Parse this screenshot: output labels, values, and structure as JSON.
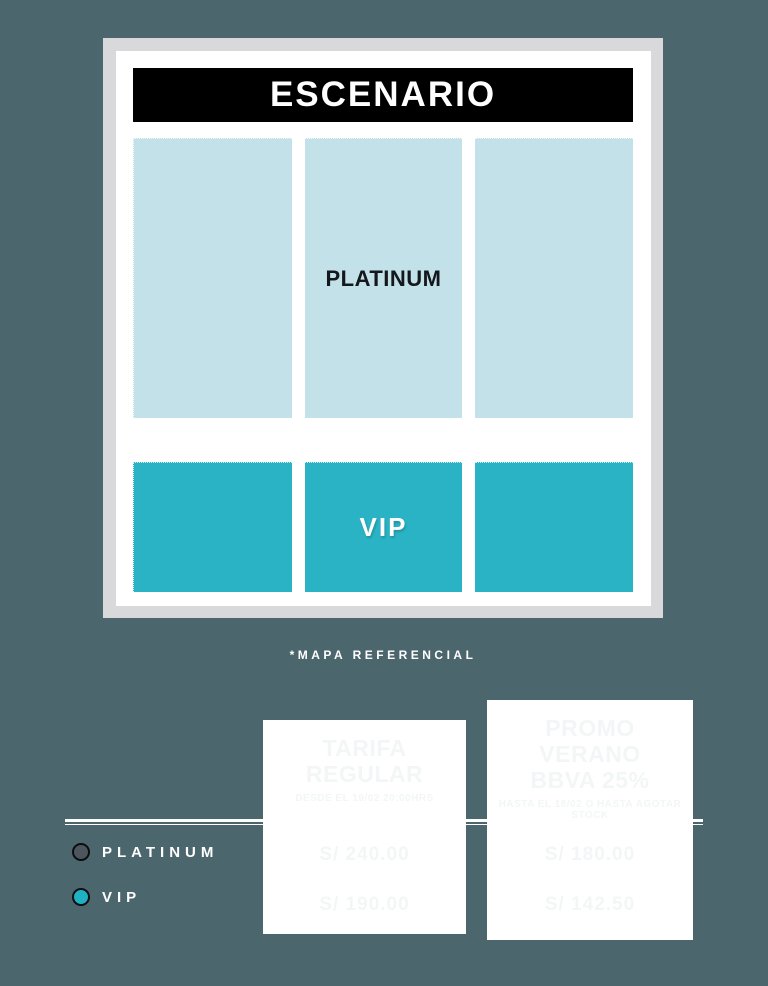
{
  "page": {
    "background_color": "#4C666E",
    "frame_color": "#D9D9DB",
    "panel_color": "#FFFFFF"
  },
  "stage_map": {
    "stage_banner": "ESCENARIO",
    "caption": "*MAPA REFERENCIAL",
    "sections": {
      "platinum": {
        "label": "PLATINUM",
        "fill": "#C2E1E8"
      },
      "vip": {
        "label": "VIP",
        "fill": "#29B3C4"
      }
    }
  },
  "legend": {
    "items": [
      {
        "label": "PLATINUM",
        "dot_color": "#4D565C"
      },
      {
        "label": "VIP",
        "dot_color": "#1FB1C1"
      }
    ]
  },
  "pricing": {
    "text_color": "#F3F6F6",
    "cards": [
      {
        "title": "TARIFA REGULAR",
        "subtitle": "DESDE EL 19/02 20:00HRS",
        "prices": [
          "S/ 240.00",
          "S/ 190.00"
        ]
      },
      {
        "title": "PROMO VERANO BBVA 25%",
        "subtitle": "HASTA EL 18/02 O HASTA AGOTAR STOCK",
        "prices": [
          "S/ 180.00",
          "S/ 142.50"
        ]
      }
    ]
  }
}
